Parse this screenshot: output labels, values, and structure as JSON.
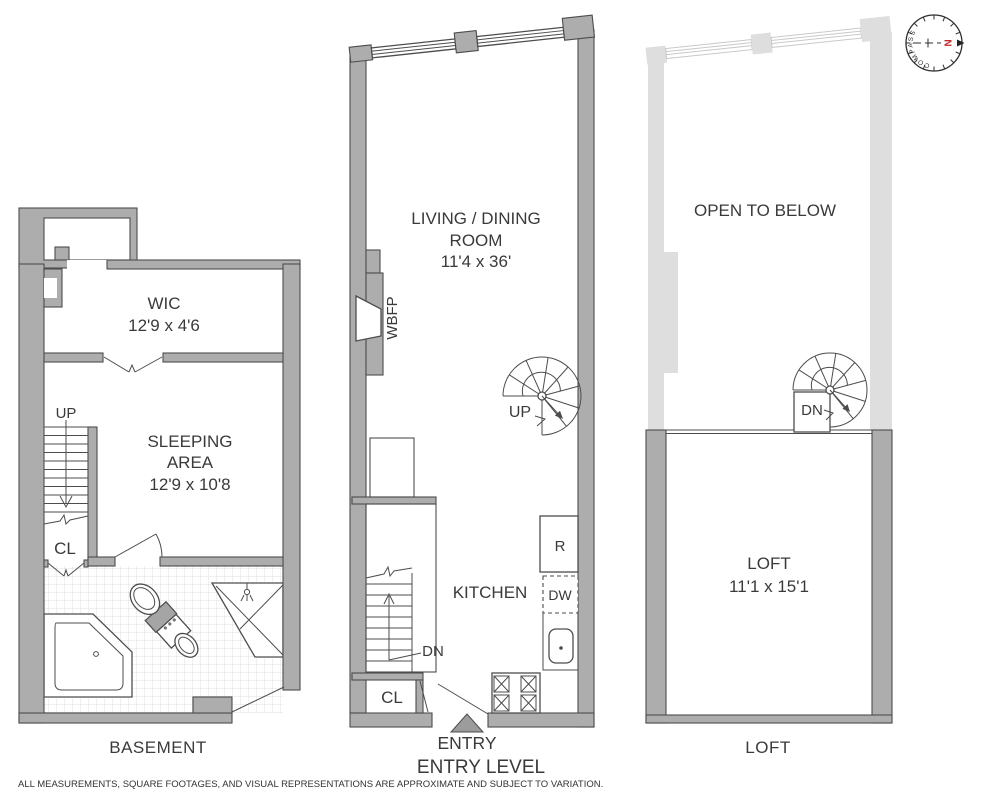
{
  "basement": {
    "title": "BASEMENT",
    "wic_name": "WIC",
    "wic_dims": "12'9 x 4'6",
    "sleeping_line1": "SLEEPING",
    "sleeping_line2": "AREA",
    "sleeping_dims": "12'9 x 10'8",
    "up": "UP",
    "cl": "CL"
  },
  "entry": {
    "title": "ENTRY LEVEL",
    "living_line1": "LIVING / DINING",
    "living_line2": "ROOM",
    "living_dims": "11'4 x 36'",
    "kitchen": "KITCHEN",
    "wbfp": "WBFP",
    "up": "UP",
    "dn": "DN",
    "cl": "CL",
    "refrigerator": "R",
    "dishwasher": "DW",
    "entry_marker": "ENTRY"
  },
  "loft": {
    "title": "LOFT",
    "open_to_below": "OPEN TO BELOW",
    "loft_name": "LOFT",
    "loft_dims": "11'1 x 15'1",
    "dn": "DN"
  },
  "compass": {
    "label": "COMPASS",
    "north": "N"
  },
  "footer": {
    "disclaimer": "ALL MEASUREMENTS, SQUARE FOOTAGES, AND VISUAL REPRESENTATIONS ARE APPROXIMATE AND SUBJECT TO VARIATION."
  },
  "colors": {
    "wall": "#adadad",
    "wall_outline": "#4d4d4d",
    "ghost_wall": "#dedede",
    "text": "#3a3a3a",
    "north_red": "#c62828",
    "tile_line": "#d6d6d6",
    "entry_triangle": "#9c9c9c"
  }
}
